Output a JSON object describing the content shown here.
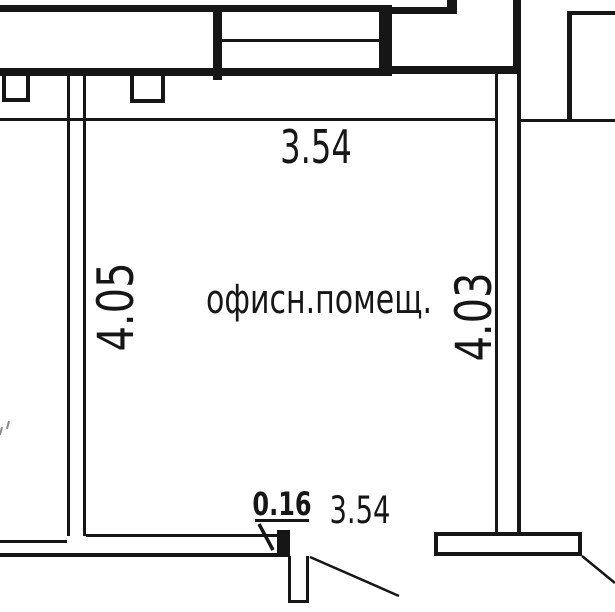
{
  "colors": {
    "line": "#161616",
    "background": "#ffffff"
  },
  "floor_plan": {
    "room_label": "офисн.помещ.",
    "dimensions": {
      "top_width": "3.54",
      "left_height": "4.05",
      "right_height": "4.03",
      "bottom_width": "3.54",
      "wall_opening": "0.16"
    }
  }
}
